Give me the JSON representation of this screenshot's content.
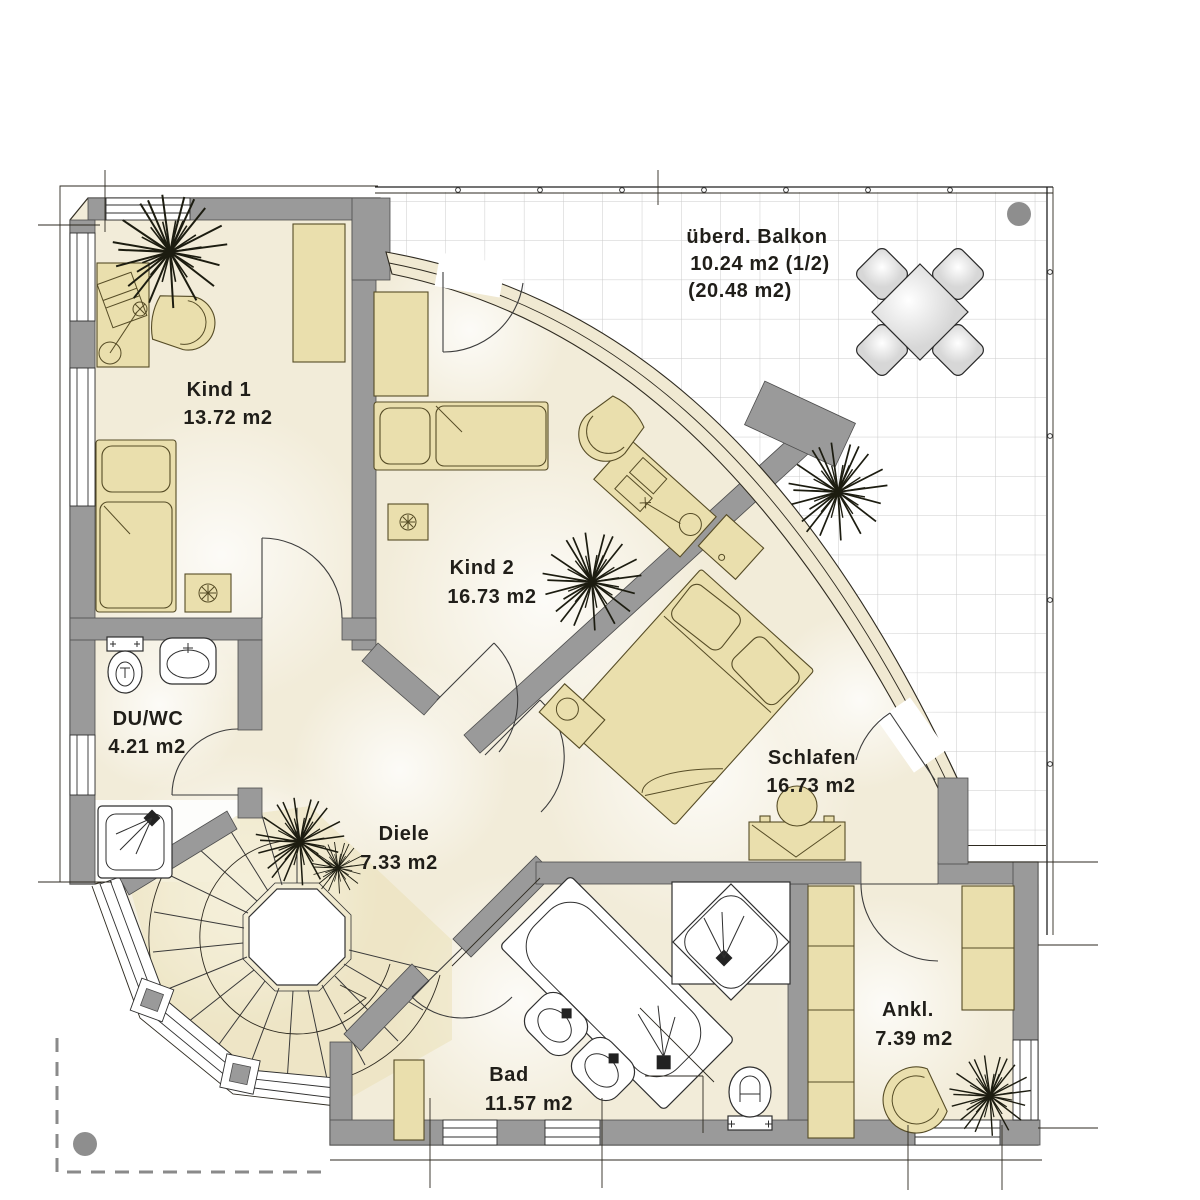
{
  "rooms": [
    {
      "id": "kind1",
      "label": "Kind 1",
      "area": "13.72 m2"
    },
    {
      "id": "kind2",
      "label": "Kind 2",
      "area": "16.73 m2"
    },
    {
      "id": "schlafen",
      "label": "Schlafen",
      "area": "16.73 m2"
    },
    {
      "id": "du-wc",
      "label": "DU/WC",
      "area": "4.21 m2"
    },
    {
      "id": "diele",
      "label": "Diele",
      "area": "7.33 m2"
    },
    {
      "id": "bad",
      "label": "Bad",
      "area": "11.57 m2"
    },
    {
      "id": "ankleide",
      "label": "Ankl.",
      "area": "7.39 m2"
    }
  ],
  "balcony": {
    "label": "überd. Balkon",
    "area_line1": "10.24 m2  (1/2)",
    "area_line2": "(20.48 m2)"
  },
  "colors": {
    "wall": "#9a9a9a",
    "floor": "#f2ecd9",
    "furniture": "#eadfad",
    "window_band": "#f0e9d2",
    "balcony_grid": "#cbcbcb",
    "dot": "#8e8e8e",
    "label": "#201e19"
  }
}
